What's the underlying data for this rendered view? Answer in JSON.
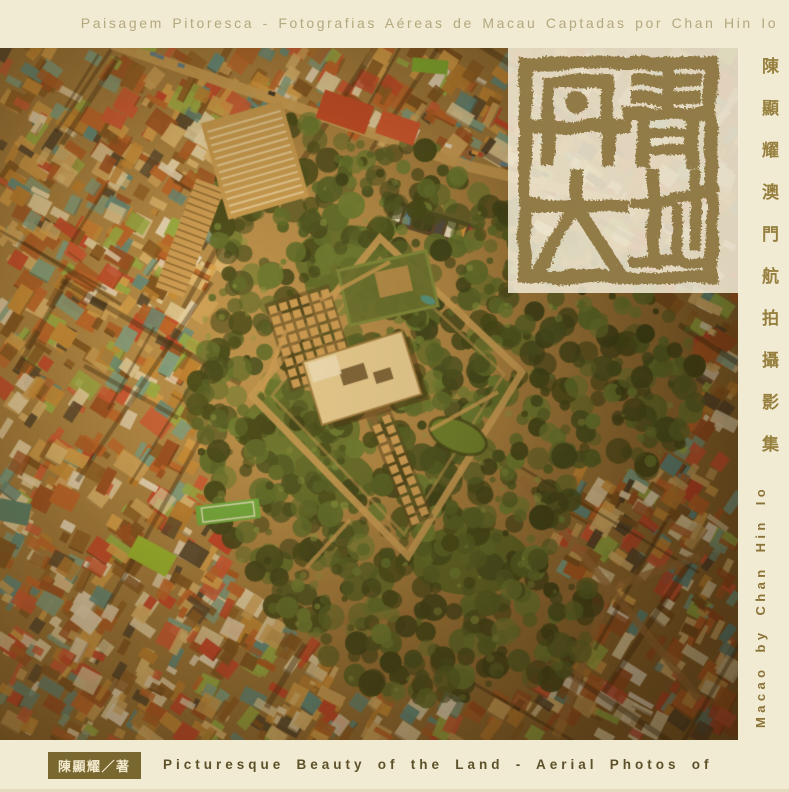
{
  "cover": {
    "top_title_pt": "Paisagem Pitoresca - Fotografias Aéreas de Macau Captadas por Chan Hin Io",
    "seal": {
      "title": "丹青大地",
      "chars": [
        "丹",
        "青",
        "大",
        "地"
      ],
      "ink_color": "#8d7540"
    },
    "spine_right": {
      "chinese": "陳顯耀澳門航拍攝影集",
      "english": "Macao by Chan Hin Io"
    },
    "bottom": {
      "author": "陳顯耀／著",
      "english": "Picturesque Beauty of the Land - Aerial Photos of"
    },
    "colors": {
      "background": "#f2ebd4",
      "top_text": "#b3a87e",
      "spine_chinese_text": "#97803f",
      "spine_english_text": "#8a7337",
      "bottom_text": "#5c5129",
      "author_box_bg": "#786830",
      "author_box_text": "#f2e9cd",
      "seal_ink": "#8d7540",
      "seal_panel": "rgba(243,236,215,0.86)"
    }
  },
  "photo": {
    "palette": {
      "base": "#7c5a28",
      "buildings": [
        "#a8501e",
        "#93401a",
        "#bc5a24",
        "#c98a34",
        "#d9a24c",
        "#b87a2c",
        "#cfa55e",
        "#e0bd78",
        "#e6d9ae",
        "#efe3c0",
        "#6e4418",
        "#82511e",
        "#c23424",
        "#d04a30",
        "#eee6d2",
        "#6fa08e",
        "#49888a",
        "#8fb244",
        "#3c3428"
      ],
      "trees": [
        "#243312",
        "#31441a",
        "#3e5520",
        "#4a6426",
        "#59752e",
        "#2c3a12"
      ],
      "lawn": [
        "#5a6e2c",
        "#57682a",
        "#516226",
        "#4c5e22"
      ],
      "road": "#c89e58",
      "path": "#cd9d58",
      "wall": "#c59b58",
      "museum": "#ead49f",
      "pond": "#5c7a28",
      "lime": "#8fbe2a",
      "cars": [
        "#f0ead8",
        "#d9973f",
        "#3a3a40",
        "#b3342a",
        "#4a7a9c",
        "#222222"
      ]
    }
  }
}
